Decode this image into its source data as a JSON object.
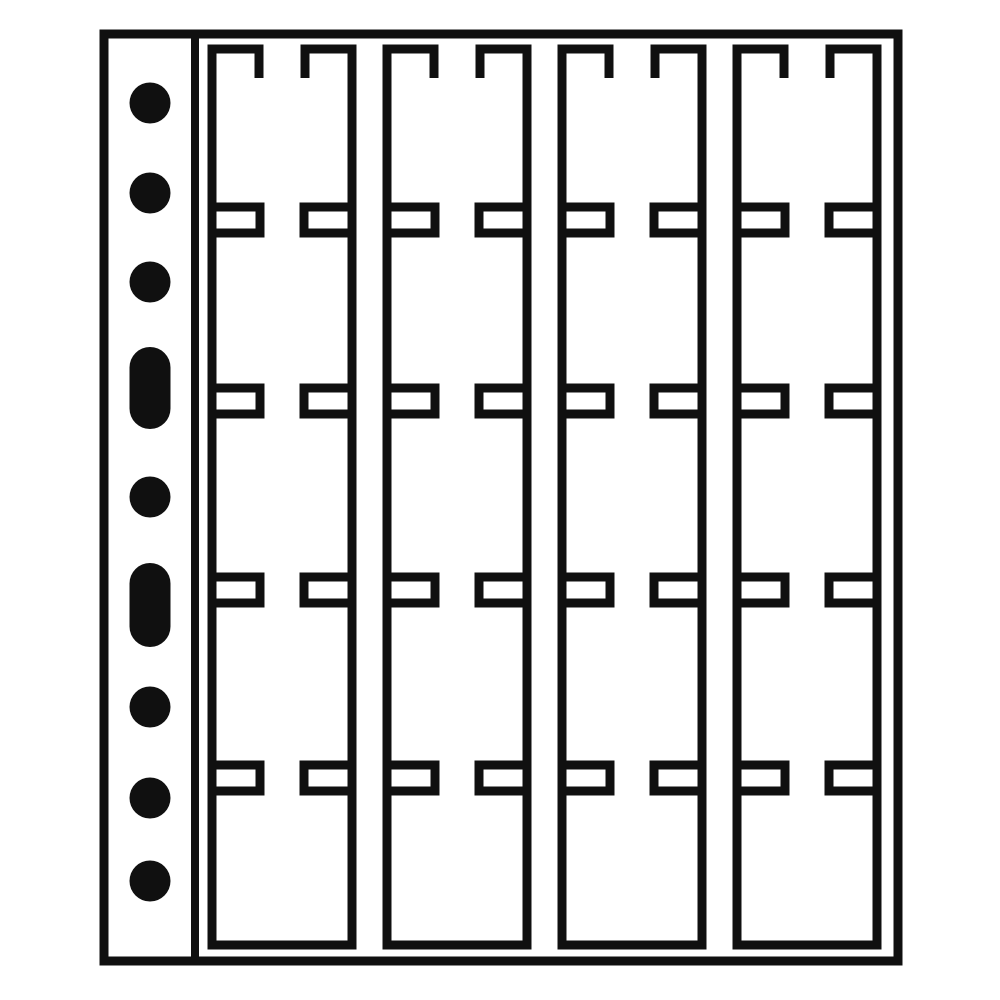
{
  "meta": {
    "description": "Black line-art illustration of a transparent coin album pocket sheet: a binder page with 9 punch holes on the left margin and a grid of 4 columns by 5 rows (20 pockets) with T-shaped insertion slits between pockets",
    "page_type": "coin-album-pocket-sheet",
    "pocket_columns": 4,
    "pocket_rows": 5,
    "pocket_count": 20,
    "punch_hole_count": 9,
    "round_hole_count": 7,
    "slotted_hole_count": 2
  },
  "colors": {
    "ink": "#101010",
    "paper": "#ffffff"
  },
  "canvas": {
    "width": 1000,
    "height": 1000
  },
  "page_outline": {
    "left": 104,
    "top": 34,
    "right": 898,
    "bottom": 961,
    "stroke": 9
  },
  "punch_strip": {
    "divider_x": 195,
    "stroke": 8
  },
  "punch_holes": {
    "cx": 150,
    "radius": 20.5,
    "slot_width": 41,
    "items": [
      {
        "type": "round",
        "cy": 103
      },
      {
        "type": "round",
        "cy": 193
      },
      {
        "type": "round",
        "cy": 282
      },
      {
        "type": "slotted",
        "cy": 388,
        "height": 82
      },
      {
        "type": "round",
        "cy": 497
      },
      {
        "type": "slotted",
        "cy": 605,
        "height": 84
      },
      {
        "type": "round",
        "cy": 707
      },
      {
        "type": "round",
        "cy": 798
      },
      {
        "type": "round",
        "cy": 881
      }
    ]
  },
  "pocket_grid": {
    "stroke": 9,
    "column_left_edges": [
      212,
      387,
      562,
      737
    ],
    "column_width": 140,
    "top_edge_y": 49,
    "bottom_edge_y": 945,
    "top_slit_half_gap": 23,
    "top_hook_depth": 29,
    "junction_centers_y": [
      220,
      401,
      590,
      778
    ],
    "junction_half_height": 13,
    "junction_tip_half_gap": 22
  }
}
